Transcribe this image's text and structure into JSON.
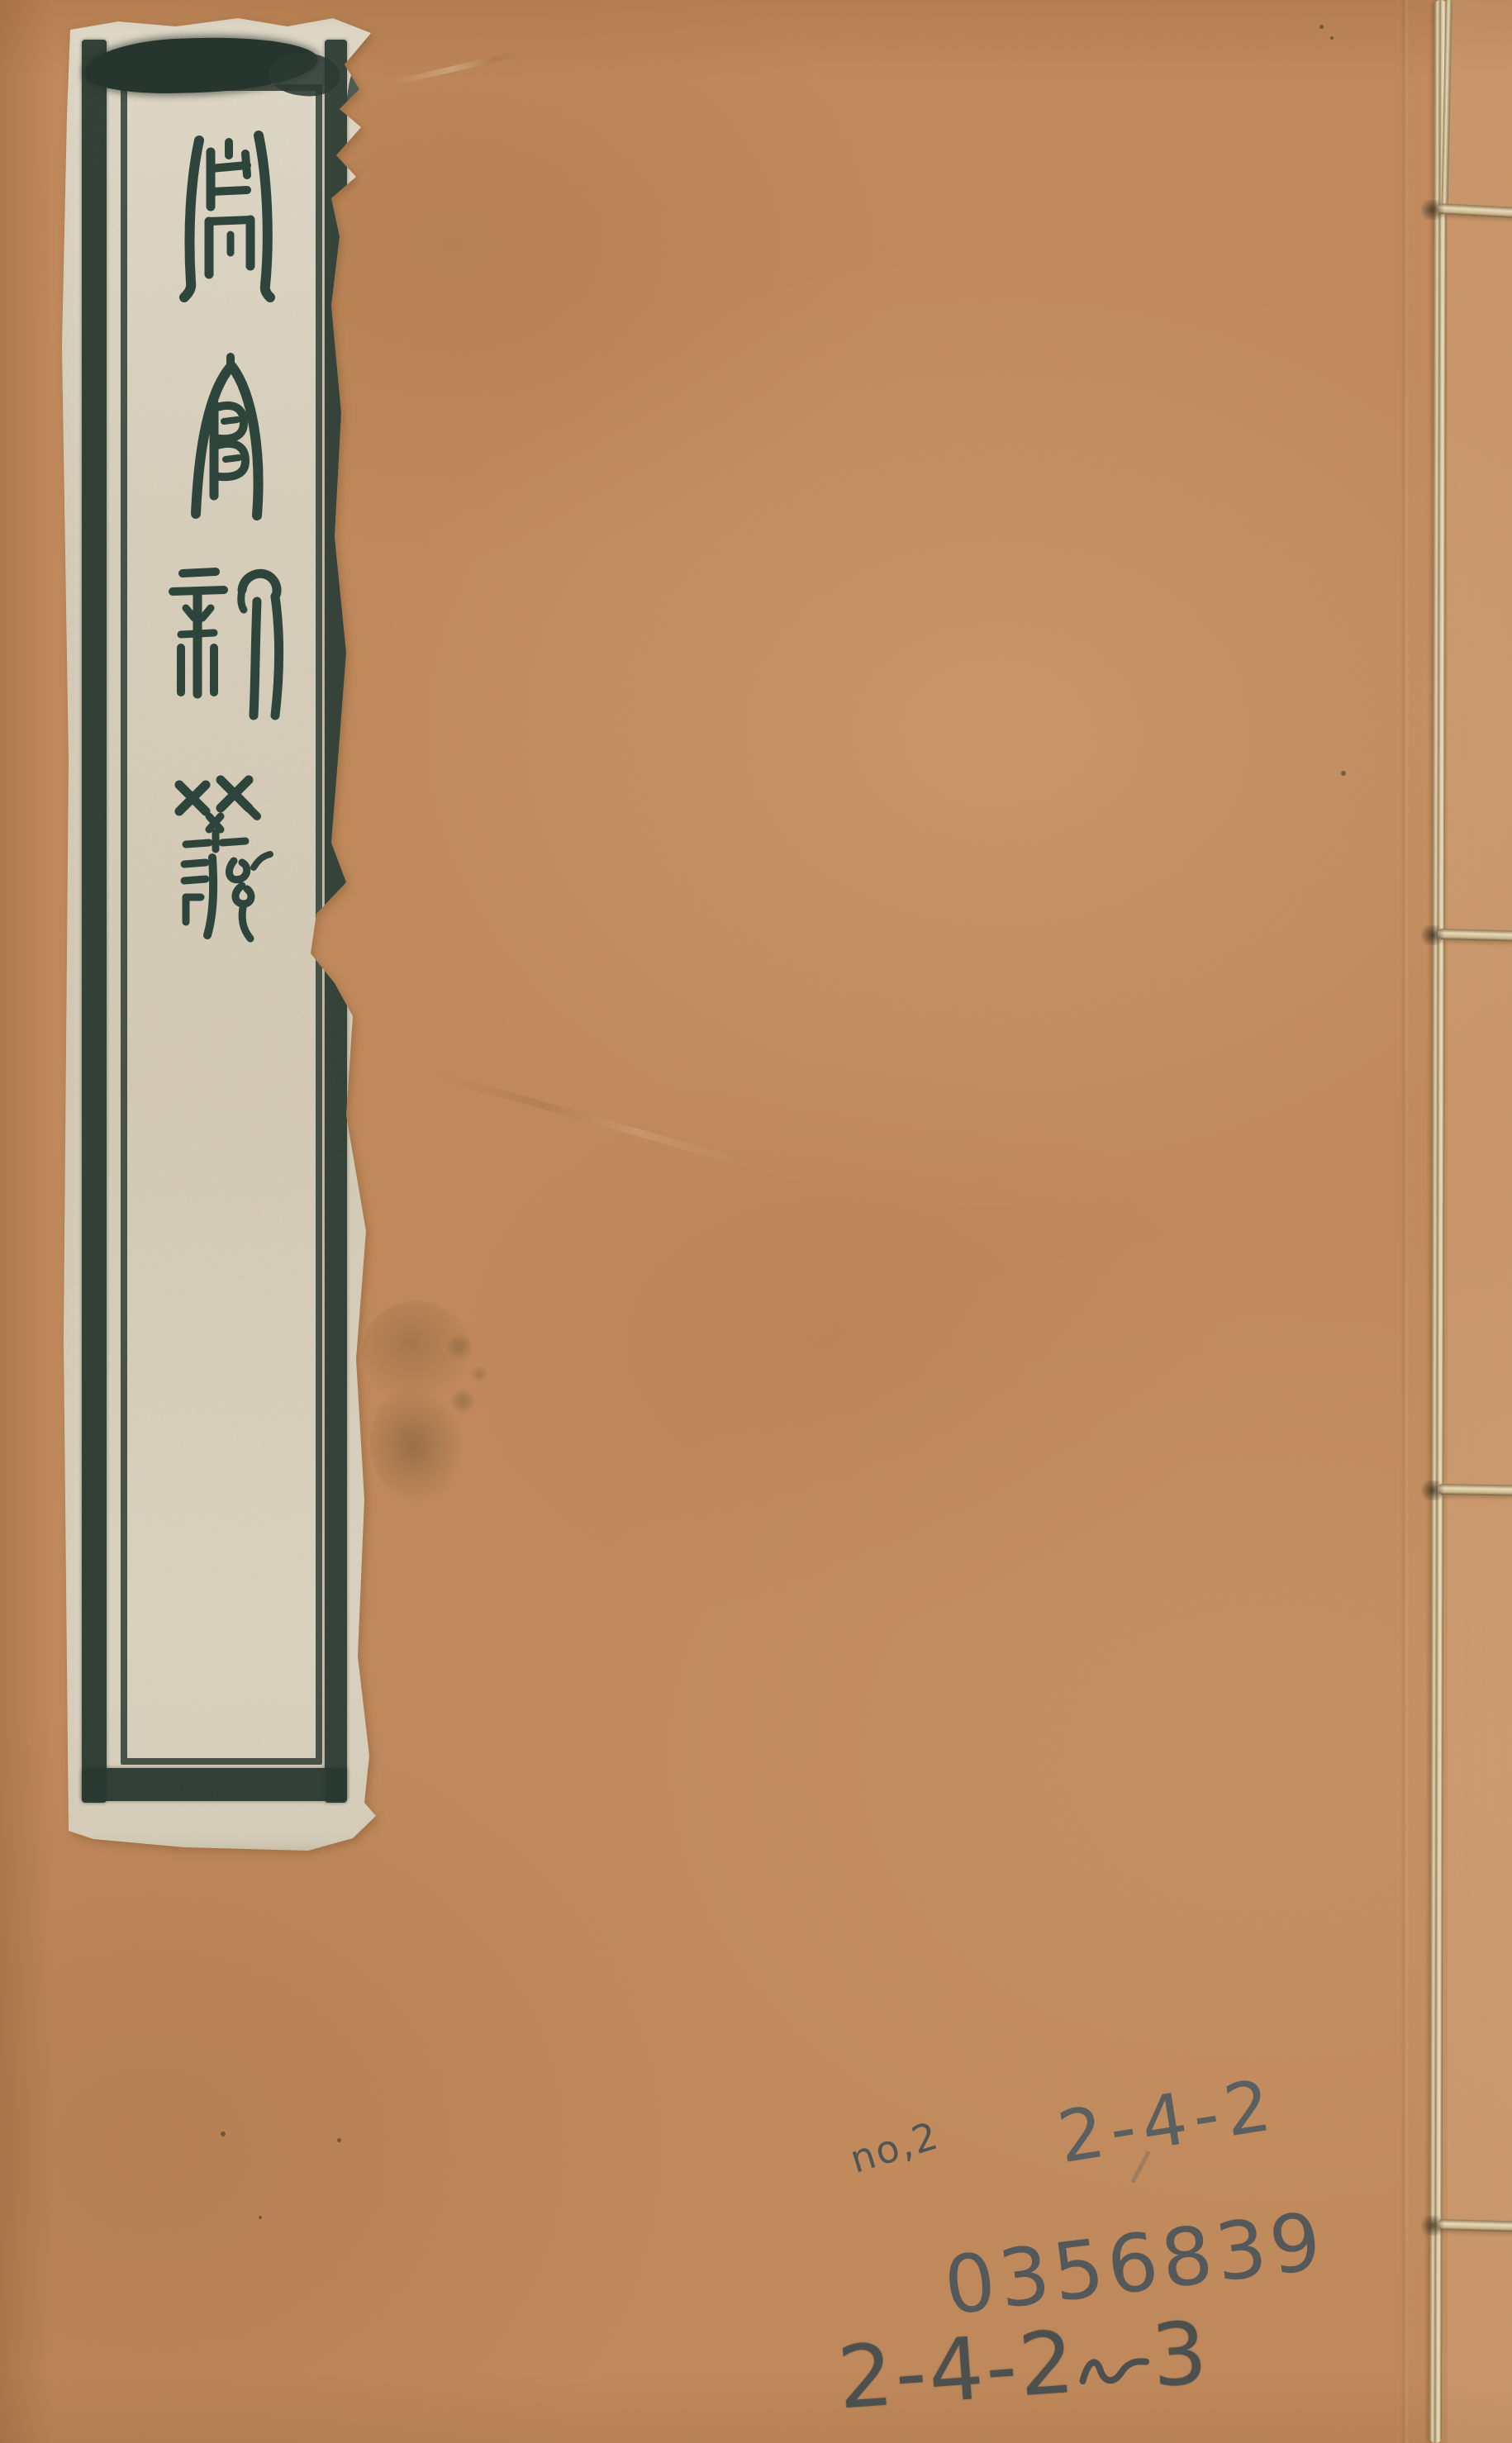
{
  "page": {
    "type": "thread-bound book cover (digitized)",
    "cover_color": "#c28a5b"
  },
  "title_label": {
    "title_text": "周官新義",
    "script_style": "seal script, printed slip with double border",
    "paper_color": "#dcd5c3",
    "ink_color": "#22342e",
    "characters": [
      {
        "char": "周",
        "name": "zhou"
      },
      {
        "char": "官",
        "name": "guan"
      },
      {
        "char": "新",
        "name": "xin"
      },
      {
        "char": "義",
        "name": "yi"
      }
    ]
  },
  "handwriting": {
    "pencil_color": "#43515a",
    "note": "no,2",
    "shelf_mark_top": "2-4-2",
    "accession_number": "0356839",
    "shelf_mark_bottom": {
      "prefix": "2-4-2",
      "connector": "の",
      "suffix": "3"
    }
  },
  "binding": {
    "thread_color": "#e9dbb9",
    "stitches": 4
  }
}
